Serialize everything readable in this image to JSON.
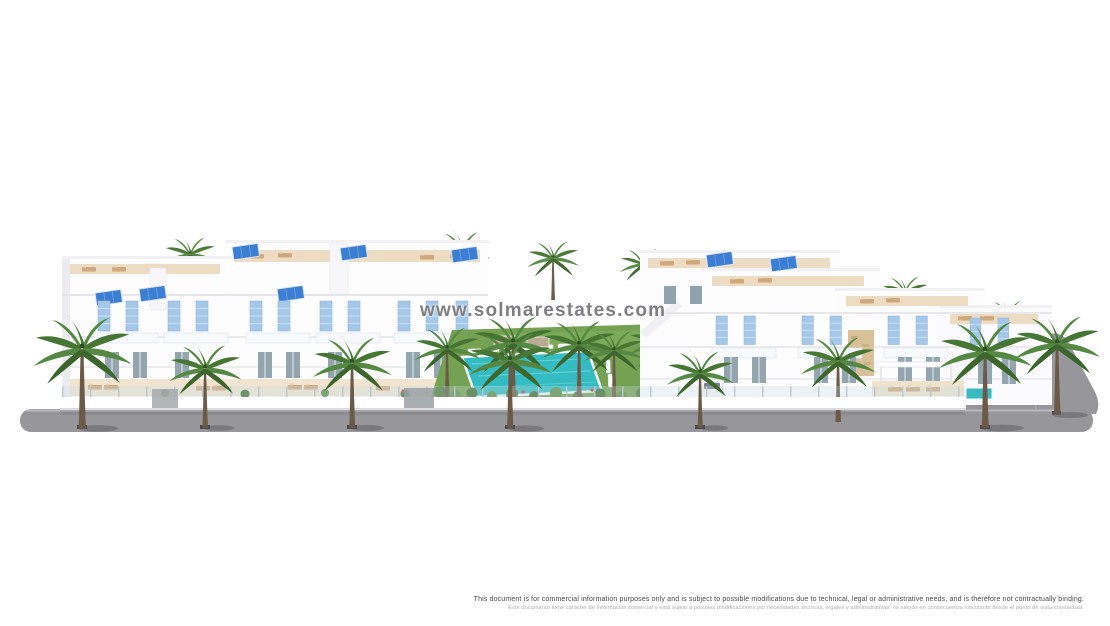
{
  "scene": {
    "watermark": "www.solmarestates.com",
    "disclaimer_en": "This document is for commercial information purposes only and is subject to possible modifications due to technical, legal or administrative needs, and is therefore not contractually binding.",
    "disclaimer_es": "Este documento tiene carácter de información comercial y está sujeto a posibles modificaciones por necesidades técnicas, legales y administrativas, no siendo en consecuencia vinculante desde el punto de vista contractual."
  },
  "palette": {
    "facade_white": "#fdfdfe",
    "solar_panel_blue": "#3c7ed2",
    "shutter_blue": "#a6c8e8",
    "pool_turquoise": "#35bcc2",
    "lawn_green": "#74a152",
    "palm_frond_green": "#4e7f3a",
    "palm_trunk_brown": "#6a5a47",
    "road_gray": "#97979b",
    "terrace_beige": "#ecdcc3"
  }
}
